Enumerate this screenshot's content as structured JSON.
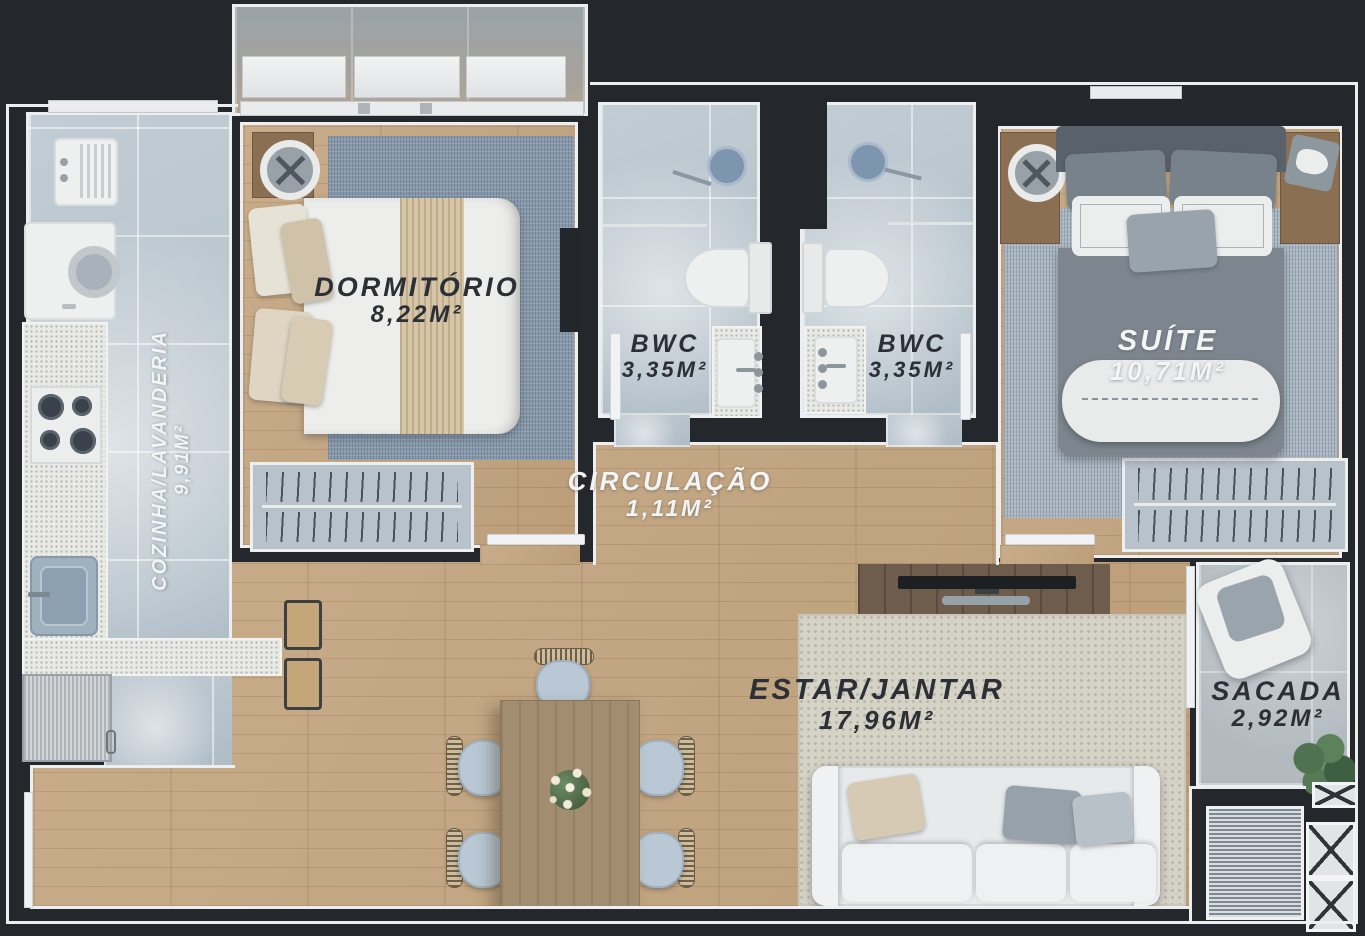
{
  "plan_title": "apartment-floor-plan",
  "rooms": [
    {
      "id": "dormitorio",
      "name": "DORMITÓRIO",
      "area": "8,22M²"
    },
    {
      "id": "bwc-left",
      "name": "BWC",
      "area": "3,35M²"
    },
    {
      "id": "bwc-right",
      "name": "BWC",
      "area": "3,35M²"
    },
    {
      "id": "suite",
      "name": "SUÍTE",
      "area": "10,71M²"
    },
    {
      "id": "cozinha",
      "name": "COZINHA/LAVANDERIA",
      "area": "9,91M²"
    },
    {
      "id": "circulacao",
      "name": "CIRCULAÇÃO",
      "area": "1,11M²"
    },
    {
      "id": "estar",
      "name": "ESTAR/JANTAR",
      "area": "17,96M²"
    },
    {
      "id": "sacada",
      "name": "SACADA",
      "area": "2,92M²"
    }
  ],
  "colors": {
    "wall": "#24272b",
    "trim": "#eceeef",
    "wood_floor": "#c2a27b",
    "tile_floor": "#c6cfd6",
    "concrete_floor": "#b2bac0",
    "rug_bedroom": "#8799ab",
    "rug_suite": "#a9b6c1",
    "rug_living": "#d5d2c6",
    "counter": "#e9eae5",
    "steel_appliance": "#c7cbce",
    "text_dark": "#2c3036",
    "text_light": "#f3f4f4"
  }
}
